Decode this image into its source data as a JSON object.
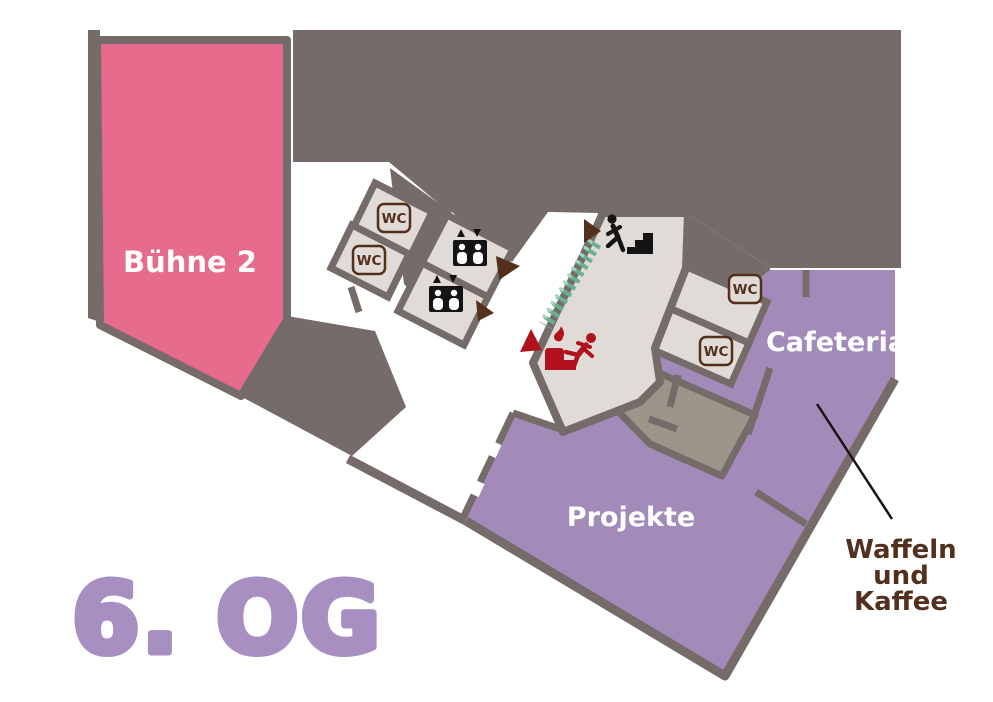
{
  "title": "6. OG",
  "map": {
    "rooms": {
      "buehne2": {
        "label": "Bühne 2",
        "color": "#e66b8c"
      },
      "projekte": {
        "label": "Projekte",
        "color": "#a28bb8"
      },
      "cafeteria": {
        "label": "Cafeteria",
        "color": "#a28bb8"
      }
    },
    "facilities": {
      "wc_label": "WC",
      "wc_count": 4,
      "elevator_icon": "elevator-icon",
      "stairs_icon": "stairs-icon",
      "emergency_exit_icon": "emergency-exit-icon",
      "hedge": "green-hedge"
    },
    "annotation": {
      "lines": [
        "Waffeln",
        "und",
        "Kaffee"
      ]
    }
  },
  "colors": {
    "background": "#ffffff",
    "structure_grey": "#756c69",
    "room_beige": "#e0dbd6",
    "room_olive": "#9b9689",
    "room_pink": "#e66b8c",
    "room_purple": "#a28bb8",
    "title_purple": "#a78fc2",
    "dark_brown": "#53301e",
    "signal_red": "#b1121e",
    "hedge_green": "#69b08e",
    "icon_black": "#141414",
    "label_white": "#ffffff"
  }
}
